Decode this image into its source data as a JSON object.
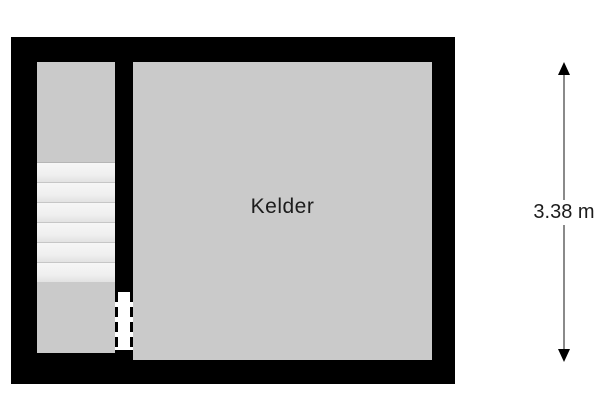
{
  "colors": {
    "background": "#ffffff",
    "wall": "#000000",
    "room-fill": "#cacaca",
    "stairs-fill": "#f0f0f0",
    "tread-edge": "#c6c6c6",
    "dimension-line": "#8a8a8a",
    "text": "#1c1c1c"
  },
  "floorplan": {
    "rooms": [
      {
        "label": "Kelder"
      }
    ],
    "stairs": {
      "steps": 6
    }
  },
  "dimension": {
    "label": "3.38 m"
  }
}
